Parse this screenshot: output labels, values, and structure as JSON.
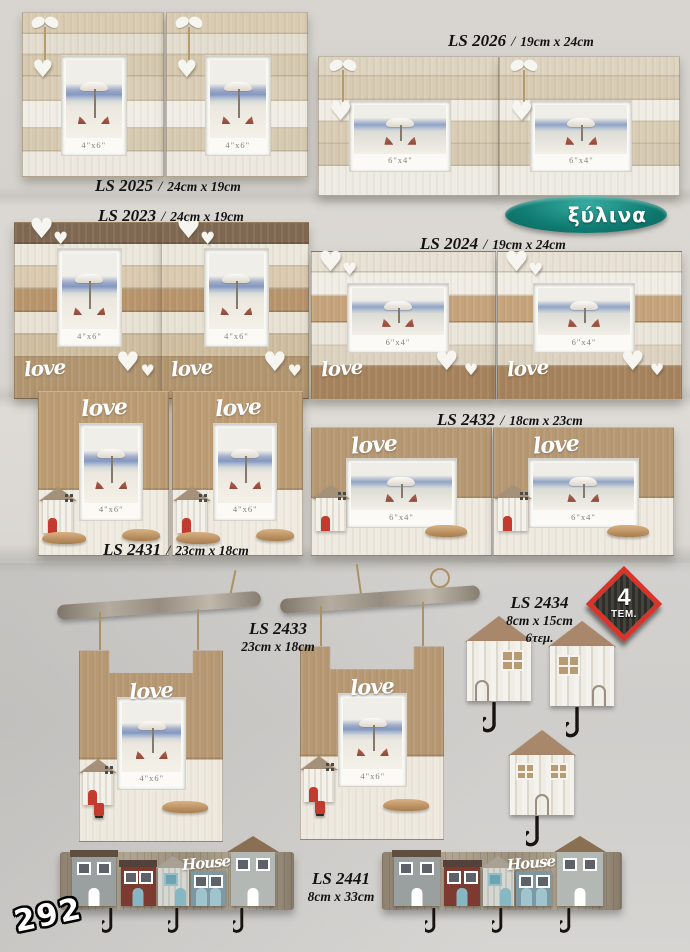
{
  "page": {
    "number": "292"
  },
  "badges": {
    "material_label": "ξύλινα",
    "pack": {
      "count": "4",
      "unit": "ΤΕΜ."
    }
  },
  "icons": {
    "heart": "♥"
  },
  "common": {
    "separator": "/",
    "love_script": "love",
    "house_script": "House",
    "caption_4x6": "4\"x6\"",
    "caption_6x4": "6\"x4\""
  },
  "products": {
    "ls2025": {
      "code": "LS 2025",
      "size": "24cm x 19cm"
    },
    "ls2026": {
      "code": "LS 2026",
      "size": "19cm x 24cm"
    },
    "ls2023": {
      "code": "LS 2023",
      "size": "24cm x 19cm"
    },
    "ls2024": {
      "code": "LS 2024",
      "size": "19cm x 24cm"
    },
    "ls2431": {
      "code": "LS 2431",
      "size": "23cm x 18cm"
    },
    "ls2432": {
      "code": "LS 2432",
      "size": "18cm x 23cm"
    },
    "ls2433": {
      "code": "LS 2433",
      "size": "23cm x 18cm"
    },
    "ls2434": {
      "code": "LS 2434",
      "size": "8cm x 15cm",
      "qty": "6τεμ."
    },
    "ls2441": {
      "code": "LS 2441",
      "size": "8cm x 33cm"
    }
  },
  "colors": {
    "badge_teal": "#0f7c72",
    "badge_red": "#d7342b",
    "wood": "#b69873",
    "whitewash": "#efebe1"
  }
}
